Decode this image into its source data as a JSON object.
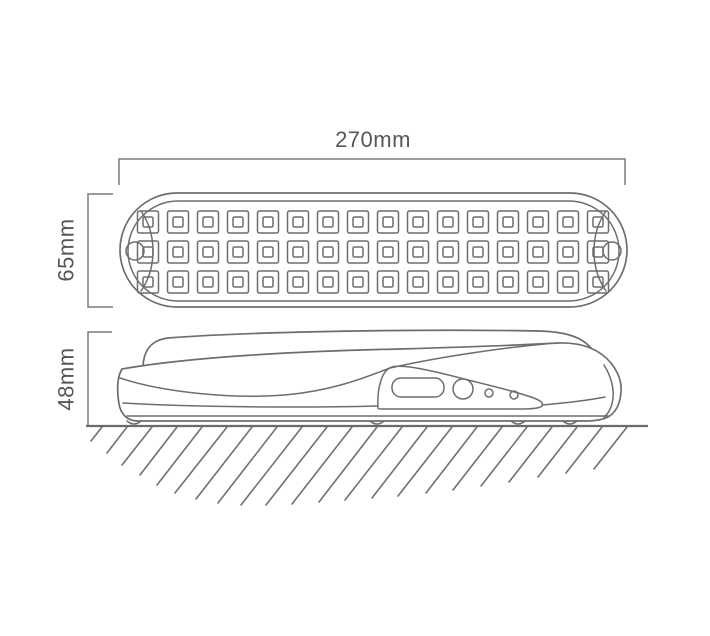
{
  "diagram": {
    "kind": "product-dimension-line-drawing",
    "views": [
      "top-view",
      "side-view"
    ]
  },
  "dimensions": {
    "width_label": "270mm",
    "height_label": "65mm",
    "depth_label": "48mm"
  },
  "top_view": {
    "led_grid": {
      "rows": 3,
      "columns": 16,
      "total_leds": 48
    },
    "mounting_holes": 2
  },
  "side_view": {
    "switch_slot_count": 1,
    "round_button_count": 1,
    "indicator_dot_count": 2,
    "feet_count": 4
  },
  "colors": {
    "line": "#6c6d70",
    "dimension_line": "#7a7b7e",
    "text": "#55565a",
    "background": "#ffffff"
  }
}
